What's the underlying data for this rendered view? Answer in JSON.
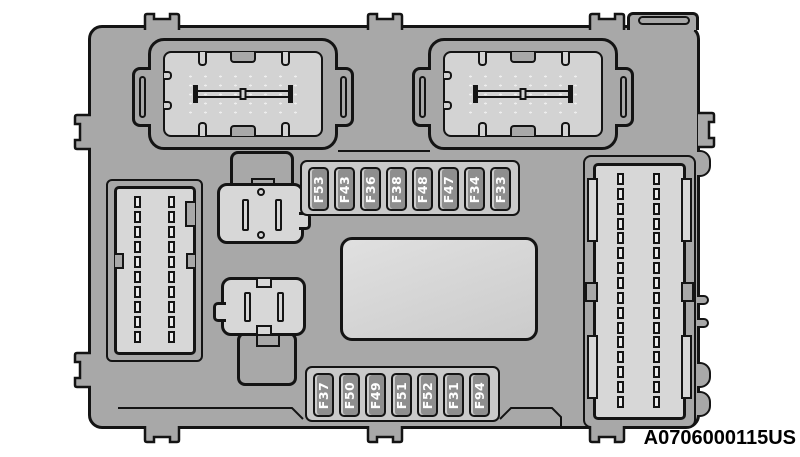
{
  "figure_code": "A0706000115US",
  "fuse_rows": {
    "top": [
      "F53",
      "F43",
      "F36",
      "F38",
      "F48",
      "F47",
      "F34",
      "F33"
    ],
    "bottom": [
      "F37",
      "F50",
      "F49",
      "F51",
      "F52",
      "F31",
      "F94"
    ]
  },
  "colors": {
    "background": "#ffffff",
    "body": "#a8a8a8",
    "panel": "#d7d7d7",
    "connector_inner": "#d3d3d3",
    "strip": "#c9c9c9",
    "fuse": "#8e8e8e",
    "outline": "#141414",
    "dots": "#efefef",
    "label_text": "#000000"
  }
}
